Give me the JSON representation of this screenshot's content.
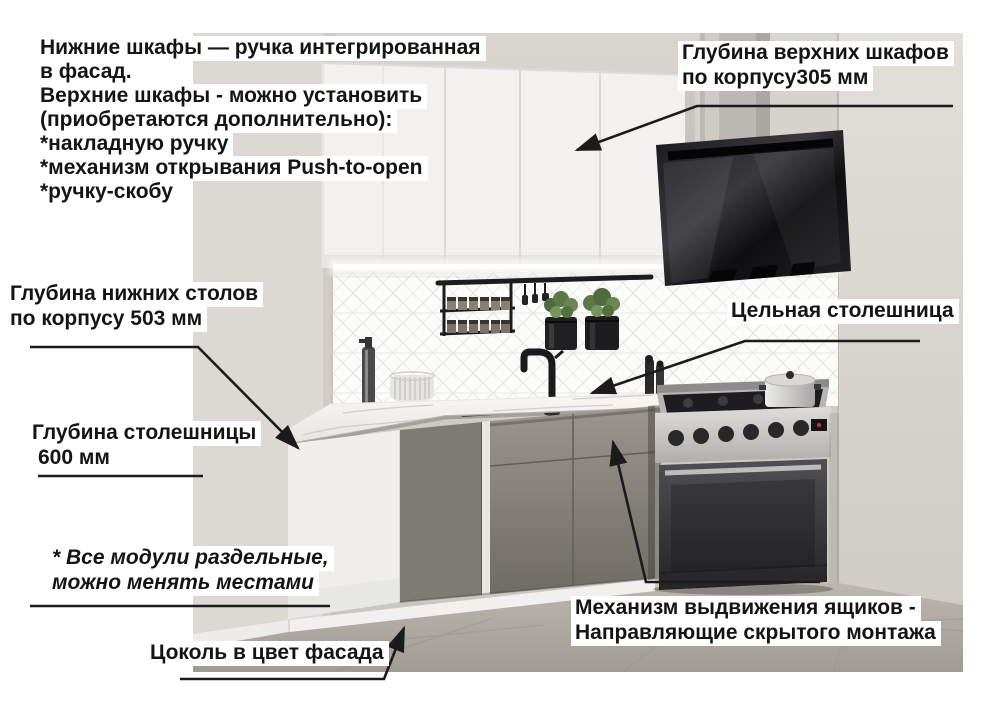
{
  "labels": {
    "handles_note": {
      "lines": [
        "Нижние шкафы — ручка интегрированная",
        "в фасад.",
        "Верхние шкафы - можно установить",
        "(приобретаются дополнительно):",
        "*накладную ручку",
        "*механизм открывания Push-to-open",
        "*ручку-скобу"
      ]
    },
    "upper_depth": {
      "lines": [
        "Глубина верхних шкафов",
        "по корпусу305 мм"
      ]
    },
    "lower_depth": {
      "lines": [
        "Глубина нижних столов",
        "по корпусу 503 мм"
      ]
    },
    "solid_top": {
      "lines": [
        "Цельная столешница"
      ]
    },
    "top_depth": {
      "lines": [
        "Глубина столешницы",
        "600 мм"
      ]
    },
    "modules_note": {
      "lines": [
        "* Все модули раздельные,",
        "можно менять местами"
      ]
    },
    "plinth": {
      "lines": [
        "Цоколь в цвет фасада"
      ]
    },
    "drawers": {
      "lines": [
        "Механизм выдвижения ящиков -",
        "Направляющие скрытого монтажа"
      ]
    }
  },
  "colors": {
    "text": "#141414",
    "arrow": "#1b1b1b",
    "label_background": "#ffffff",
    "wall": "#d6d2cd",
    "upper_cabinets": "#f2f1ef",
    "base_cabinets": "#8a877f",
    "hood": "#141416",
    "countertop": "#f1efec",
    "plinth": "#f1f0ee",
    "floor": "#aeaaa2",
    "plants": "#5d7747"
  }
}
